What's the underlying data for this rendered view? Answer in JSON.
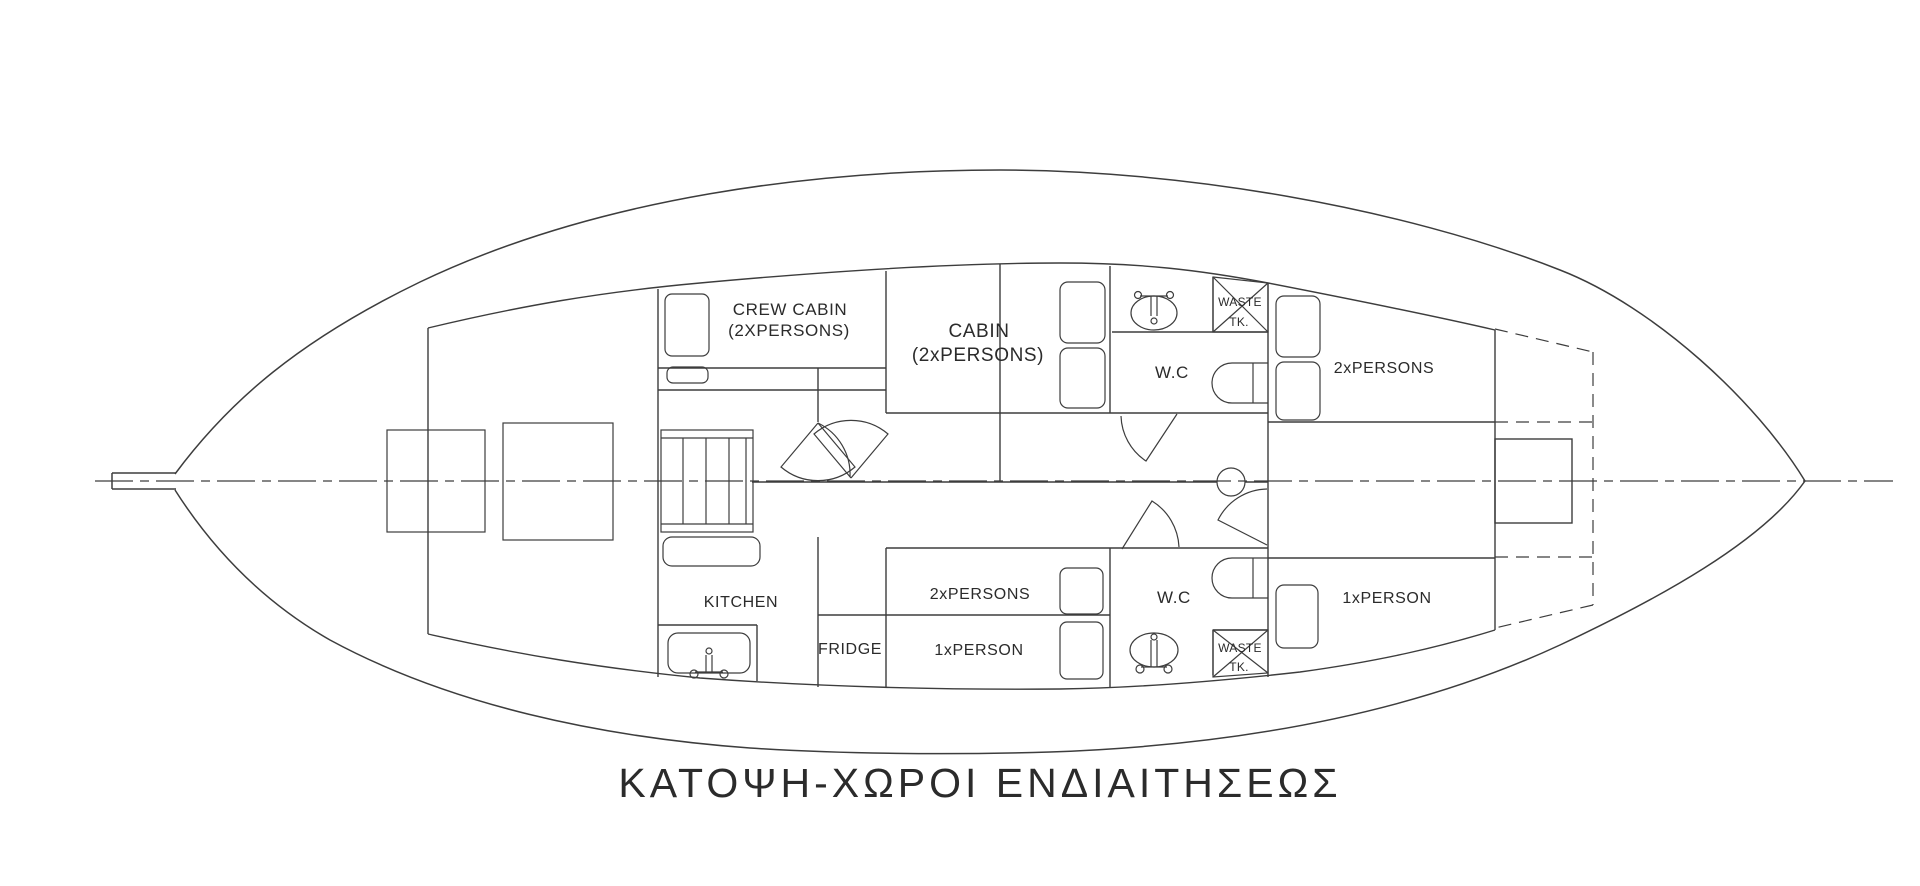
{
  "drawing": {
    "title": "ΚΑΤΟΨΗ-ΧΩΡΟΙ ΕΝΔΙΑΙΤΗΣΕΩΣ",
    "labels": {
      "crew_cabin_name": "CREW CABIN",
      "crew_cabin_capacity": "(2XPERSONS)",
      "main_cabin_name": "CABIN",
      "main_cabin_capacity": "(2xPERSONS)",
      "wc_upper": "W.C",
      "wc_lower": "W.C",
      "waste_tank_upper_line1": "WASTE",
      "waste_tank_upper_line2": "TK.",
      "waste_tank_lower_line1": "WASTE",
      "waste_tank_lower_line2": "TK.",
      "cabin_fwd_upper_capacity": "2xPERSONS",
      "cabin_mid_double_capacity": "2xPERSONS",
      "cabin_mid_single_capacity": "1xPERSON",
      "cabin_fwd_lower_capacity": "1xPERSON",
      "kitchen": "KITCHEN",
      "fridge": "FRIDGE"
    },
    "colors": {
      "line": "#3d3d3d",
      "text": "#2b2b2b",
      "background": "#ffffff"
    }
  }
}
